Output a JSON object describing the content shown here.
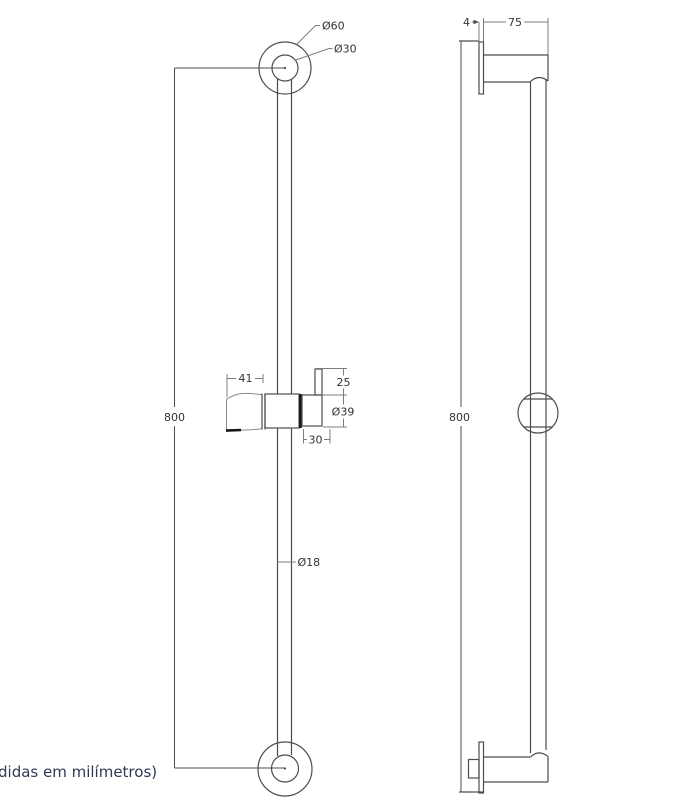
{
  "caption": "didas em milímetros)",
  "colors": {
    "background": "#ffffff",
    "line": "#4d4d4d",
    "dim_line": "#7d7d7d",
    "thick_mark": "#161616",
    "dim_text": "#333333",
    "caption_text": "#2c3a52"
  },
  "front_view": {
    "labels": {
      "outer_diameter": "Ø60",
      "inner_diameter": "Ø30",
      "height": "800",
      "holder_width": "41",
      "knob_height": "25",
      "slider_diameter": "Ø39",
      "holder_offset": "30",
      "bar_diameter": "Ø18"
    }
  },
  "side_view": {
    "labels": {
      "plate_thickness": "4",
      "wall_offset": "75",
      "height": "800"
    }
  }
}
